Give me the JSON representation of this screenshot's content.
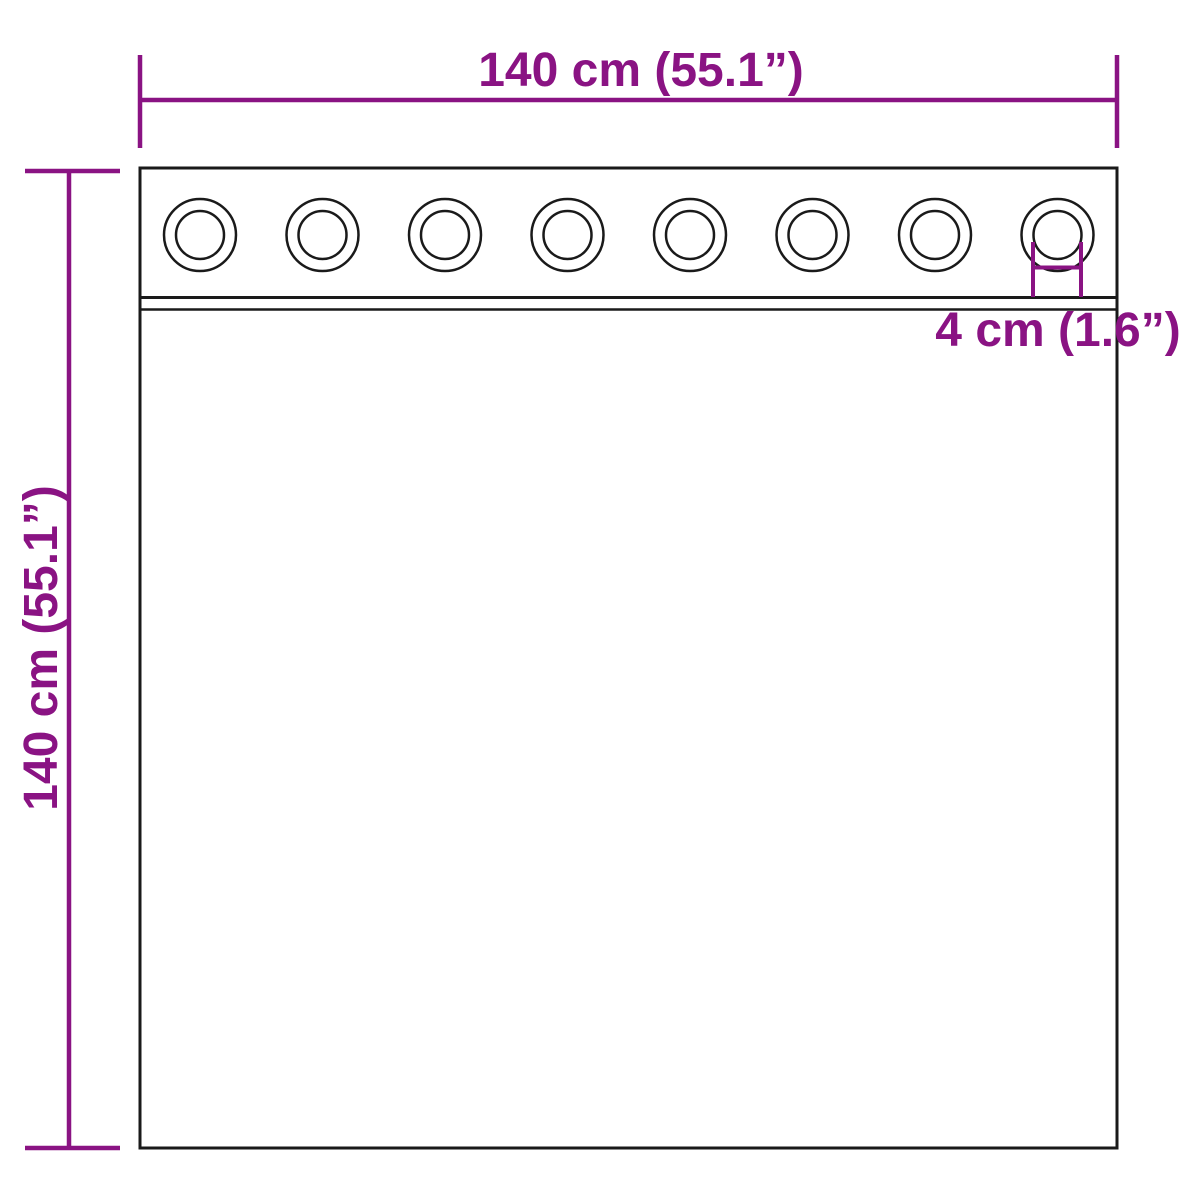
{
  "diagram": {
    "labels": {
      "width": "140 cm (55.1”)",
      "height": "140 cm (55.1”)",
      "grommet": "4 cm (1.6”)"
    },
    "grommet_count": 8,
    "colors": {
      "dimension": "#8a1383",
      "outline": "#1a1a1a",
      "background": "#ffffff"
    }
  }
}
